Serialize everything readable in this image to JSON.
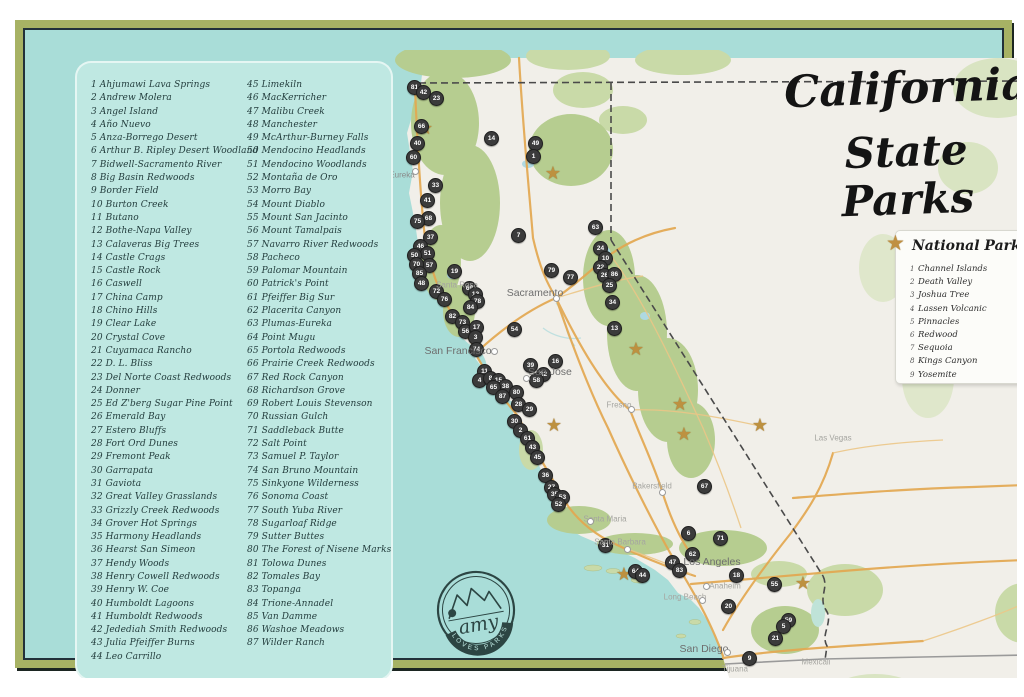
{
  "title": {
    "line1": "California",
    "line2": "State Parks"
  },
  "legend": {
    "title": "National Parks",
    "items": [
      {
        "n": 1,
        "name": "Channel Islands"
      },
      {
        "n": 2,
        "name": "Death Valley"
      },
      {
        "n": 3,
        "name": "Joshua Tree"
      },
      {
        "n": 4,
        "name": "Lassen Volcanic"
      },
      {
        "n": 5,
        "name": "Pinnacles"
      },
      {
        "n": 6,
        "name": "Redwood"
      },
      {
        "n": 7,
        "name": "Sequoia"
      },
      {
        "n": 8,
        "name": "Kings Canyon"
      },
      {
        "n": 9,
        "name": "Yosemite"
      }
    ]
  },
  "logo": {
    "script": "amy",
    "arc": "LOVES PARKS"
  },
  "parks_list": {
    "column1": [
      {
        "n": 1,
        "name": "Ahjumawi Lava Springs"
      },
      {
        "n": 2,
        "name": "Andrew Molera"
      },
      {
        "n": 3,
        "name": "Angel Island"
      },
      {
        "n": 4,
        "name": "Año Nuevo"
      },
      {
        "n": 5,
        "name": "Anza-Borrego Desert"
      },
      {
        "n": 6,
        "name": "Arthur B. Ripley Desert Woodland"
      },
      {
        "n": 7,
        "name": "Bidwell-Sacramento River"
      },
      {
        "n": 8,
        "name": "Big Basin Redwoods"
      },
      {
        "n": 9,
        "name": "Border Field"
      },
      {
        "n": 10,
        "name": "Burton Creek"
      },
      {
        "n": 11,
        "name": "Butano"
      },
      {
        "n": 12,
        "name": "Bothe-Napa Valley"
      },
      {
        "n": 13,
        "name": "Calaveras Big Trees"
      },
      {
        "n": 14,
        "name": "Castle Crags"
      },
      {
        "n": 15,
        "name": "Castle Rock"
      },
      {
        "n": 16,
        "name": "Caswell"
      },
      {
        "n": 17,
        "name": "China Camp"
      },
      {
        "n": 18,
        "name": "Chino Hills"
      },
      {
        "n": 19,
        "name": "Clear Lake"
      },
      {
        "n": 20,
        "name": "Crystal Cove"
      },
      {
        "n": 21,
        "name": "Cuyamaca Rancho"
      },
      {
        "n": 22,
        "name": "D. L. Bliss"
      },
      {
        "n": 23,
        "name": "Del Norte Coast Redwoods"
      },
      {
        "n": 24,
        "name": "Donner"
      },
      {
        "n": 25,
        "name": "Ed Z'berg Sugar Pine Point"
      },
      {
        "n": 26,
        "name": "Emerald Bay"
      },
      {
        "n": 27,
        "name": "Estero Bluffs"
      },
      {
        "n": 28,
        "name": "Fort Ord Dunes"
      },
      {
        "n": 29,
        "name": "Fremont Peak"
      },
      {
        "n": 30,
        "name": "Garrapata"
      },
      {
        "n": 31,
        "name": "Gaviota"
      },
      {
        "n": 32,
        "name": "Great Valley Grasslands"
      },
      {
        "n": 33,
        "name": "Grizzly Creek Redwoods"
      },
      {
        "n": 34,
        "name": "Grover Hot Springs"
      },
      {
        "n": 35,
        "name": "Harmony Headlands"
      },
      {
        "n": 36,
        "name": "Hearst San Simeon"
      },
      {
        "n": 37,
        "name": "Hendy Woods"
      },
      {
        "n": 38,
        "name": "Henry Cowell Redwoods"
      },
      {
        "n": 39,
        "name": "Henry W. Coe"
      },
      {
        "n": 40,
        "name": "Humboldt Lagoons"
      },
      {
        "n": 41,
        "name": "Humboldt Redwoods"
      },
      {
        "n": 42,
        "name": "Jedediah Smith Redwoods"
      },
      {
        "n": 43,
        "name": "Julia Pfeiffer Burns"
      },
      {
        "n": 44,
        "name": "Leo Carrillo"
      }
    ],
    "column2": [
      {
        "n": 45,
        "name": "Limekiln"
      },
      {
        "n": 46,
        "name": "MacKerricher"
      },
      {
        "n": 47,
        "name": "Malibu Creek"
      },
      {
        "n": 48,
        "name": "Manchester"
      },
      {
        "n": 49,
        "name": "McArthur-Burney Falls"
      },
      {
        "n": 50,
        "name": "Mendocino Headlands"
      },
      {
        "n": 51,
        "name": "Mendocino Woodlands"
      },
      {
        "n": 52,
        "name": "Montaña de Oro"
      },
      {
        "n": 53,
        "name": "Morro Bay"
      },
      {
        "n": 54,
        "name": "Mount Diablo"
      },
      {
        "n": 55,
        "name": "Mount San Jacinto"
      },
      {
        "n": 56,
        "name": "Mount Tamalpais"
      },
      {
        "n": 57,
        "name": "Navarro River Redwoods"
      },
      {
        "n": 58,
        "name": "Pacheco"
      },
      {
        "n": 59,
        "name": "Palomar Mountain"
      },
      {
        "n": 60,
        "name": "Patrick's Point"
      },
      {
        "n": 61,
        "name": "Pfeiffer Big Sur"
      },
      {
        "n": 62,
        "name": "Placerita Canyon"
      },
      {
        "n": 63,
        "name": "Plumas-Eureka"
      },
      {
        "n": 64,
        "name": "Point Mugu"
      },
      {
        "n": 65,
        "name": "Portola Redwoods"
      },
      {
        "n": 66,
        "name": "Prairie Creek Redwoods"
      },
      {
        "n": 67,
        "name": "Red Rock Canyon"
      },
      {
        "n": 68,
        "name": "Richardson Grove"
      },
      {
        "n": 69,
        "name": "Robert Louis Stevenson"
      },
      {
        "n": 70,
        "name": "Russian Gulch"
      },
      {
        "n": 71,
        "name": "Saddleback Butte"
      },
      {
        "n": 72,
        "name": "Salt Point"
      },
      {
        "n": 73,
        "name": "Samuel P. Taylor"
      },
      {
        "n": 74,
        "name": "San Bruno Mountain"
      },
      {
        "n": 75,
        "name": "Sinkyone Wilderness"
      },
      {
        "n": 76,
        "name": "Sonoma Coast"
      },
      {
        "n": 77,
        "name": "South Yuba River"
      },
      {
        "n": 78,
        "name": "Sugarloaf Ridge"
      },
      {
        "n": 79,
        "name": "Sutter Buttes"
      },
      {
        "n": 80,
        "name": "The Forest of Nisene Marks"
      },
      {
        "n": 81,
        "name": "Tolowa Dunes"
      },
      {
        "n": 82,
        "name": "Tomales Bay"
      },
      {
        "n": 83,
        "name": "Topanga"
      },
      {
        "n": 84,
        "name": "Trione-Annadel"
      },
      {
        "n": 85,
        "name": "Van Damme"
      },
      {
        "n": 86,
        "name": "Washoe Meadows"
      },
      {
        "n": 87,
        "name": "Wilder Ranch"
      }
    ]
  },
  "map": {
    "cities": [
      {
        "name": "Eureka",
        "x": 379,
        "y": 147,
        "cls": "",
        "dot": {
          "x": 392,
          "y": 143
        }
      },
      {
        "name": "Santa Rosa",
        "x": 434,
        "y": 257,
        "cls": "faint",
        "dot": null
      },
      {
        "name": "Sacramento",
        "x": 512,
        "y": 265,
        "cls": "major",
        "dot": {
          "x": 533,
          "y": 270
        }
      },
      {
        "name": "San Francisco",
        "x": 435,
        "y": 323,
        "cls": "major",
        "dot": {
          "x": 471,
          "y": 323
        }
      },
      {
        "name": "San Jose",
        "x": 527,
        "y": 344,
        "cls": "major",
        "dot": {
          "x": 503,
          "y": 350
        }
      },
      {
        "name": "Fresno",
        "x": 596,
        "y": 377,
        "cls": "faint",
        "dot": {
          "x": 608,
          "y": 381
        }
      },
      {
        "name": "Las Vegas",
        "x": 810,
        "y": 410,
        "cls": "faint",
        "dot": null
      },
      {
        "name": "Bakersfield",
        "x": 629,
        "y": 458,
        "cls": "faint",
        "dot": {
          "x": 639,
          "y": 464
        }
      },
      {
        "name": "Santa Maria",
        "x": 582,
        "y": 491,
        "cls": "faint",
        "dot": {
          "x": 567,
          "y": 493
        }
      },
      {
        "name": "Santa Barbara",
        "x": 597,
        "y": 514,
        "cls": "faint",
        "dot": {
          "x": 604,
          "y": 521
        }
      },
      {
        "name": "Los Angeles",
        "x": 689,
        "y": 534,
        "cls": "major",
        "dot": null
      },
      {
        "name": "Anaheim",
        "x": 702,
        "y": 558,
        "cls": "faint",
        "dot": {
          "x": 683,
          "y": 558
        }
      },
      {
        "name": "Long Beach",
        "x": 662,
        "y": 569,
        "cls": "faint",
        "dot": {
          "x": 679,
          "y": 572
        }
      },
      {
        "name": "San Diego",
        "x": 681,
        "y": 621,
        "cls": "major",
        "dot": {
          "x": 704,
          "y": 624
        }
      },
      {
        "name": "Tijuana",
        "x": 712,
        "y": 641,
        "cls": "faint",
        "dot": null
      },
      {
        "name": "Mexicali",
        "x": 793,
        "y": 634,
        "cls": "faint",
        "dot": null
      }
    ],
    "stars": [
      {
        "name": "Redwood",
        "x": 402,
        "y": 101
      },
      {
        "name": "Lassen Volcanic",
        "x": 530,
        "y": 146
      },
      {
        "name": "Yosemite",
        "x": 613,
        "y": 322
      },
      {
        "name": "Kings Canyon",
        "x": 657,
        "y": 377
      },
      {
        "name": "Sequoia",
        "x": 661,
        "y": 407
      },
      {
        "name": "Death Valley",
        "x": 737,
        "y": 398
      },
      {
        "name": "Pinnacles",
        "x": 531,
        "y": 398
      },
      {
        "name": "Channel Islands",
        "x": 601,
        "y": 547
      },
      {
        "name": "Joshua Tree",
        "x": 780,
        "y": 556
      }
    ],
    "markers": [
      {
        "n": 81,
        "x": 391,
        "y": 59
      },
      {
        "n": 42,
        "x": 400,
        "y": 64
      },
      {
        "n": 23,
        "x": 413,
        "y": 70
      },
      {
        "n": 66,
        "x": 398,
        "y": 98
      },
      {
        "n": 40,
        "x": 394,
        "y": 115
      },
      {
        "n": 60,
        "x": 390,
        "y": 129
      },
      {
        "n": 14,
        "x": 468,
        "y": 110
      },
      {
        "n": 49,
        "x": 512,
        "y": 115
      },
      {
        "n": 1,
        "x": 510,
        "y": 128
      },
      {
        "n": 7,
        "x": 495,
        "y": 207
      },
      {
        "n": 33,
        "x": 412,
        "y": 157
      },
      {
        "n": 41,
        "x": 404,
        "y": 172
      },
      {
        "n": 68,
        "x": 405,
        "y": 190
      },
      {
        "n": 75,
        "x": 394,
        "y": 193
      },
      {
        "n": 37,
        "x": 407,
        "y": 209
      },
      {
        "n": 46,
        "x": 397,
        "y": 218
      },
      {
        "n": 51,
        "x": 404,
        "y": 225
      },
      {
        "n": 50,
        "x": 391,
        "y": 227
      },
      {
        "n": 57,
        "x": 406,
        "y": 237
      },
      {
        "n": 70,
        "x": 393,
        "y": 236
      },
      {
        "n": 85,
        "x": 396,
        "y": 245
      },
      {
        "n": 48,
        "x": 398,
        "y": 255
      },
      {
        "n": 19,
        "x": 431,
        "y": 243
      },
      {
        "n": 69,
        "x": 446,
        "y": 260
      },
      {
        "n": 12,
        "x": 452,
        "y": 266
      },
      {
        "n": 72,
        "x": 413,
        "y": 263
      },
      {
        "n": 76,
        "x": 421,
        "y": 271
      },
      {
        "n": 78,
        "x": 454,
        "y": 273
      },
      {
        "n": 84,
        "x": 447,
        "y": 279
      },
      {
        "n": 82,
        "x": 429,
        "y": 288
      },
      {
        "n": 73,
        "x": 439,
        "y": 294
      },
      {
        "n": 56,
        "x": 442,
        "y": 303
      },
      {
        "n": 17,
        "x": 453,
        "y": 299
      },
      {
        "n": 3,
        "x": 452,
        "y": 309
      },
      {
        "n": 74,
        "x": 453,
        "y": 321
      },
      {
        "n": 63,
        "x": 572,
        "y": 199
      },
      {
        "n": 24,
        "x": 577,
        "y": 220
      },
      {
        "n": 10,
        "x": 582,
        "y": 230
      },
      {
        "n": 22,
        "x": 577,
        "y": 239
      },
      {
        "n": 26,
        "x": 581,
        "y": 247
      },
      {
        "n": 86,
        "x": 591,
        "y": 246
      },
      {
        "n": 25,
        "x": 586,
        "y": 257
      },
      {
        "n": 34,
        "x": 589,
        "y": 274
      },
      {
        "n": 13,
        "x": 591,
        "y": 300
      },
      {
        "n": 77,
        "x": 547,
        "y": 249
      },
      {
        "n": 79,
        "x": 528,
        "y": 242
      },
      {
        "n": 54,
        "x": 491,
        "y": 301
      },
      {
        "n": 39,
        "x": 507,
        "y": 337
      },
      {
        "n": 32,
        "x": 520,
        "y": 346
      },
      {
        "n": 16,
        "x": 532,
        "y": 333
      },
      {
        "n": 58,
        "x": 513,
        "y": 352
      },
      {
        "n": 11,
        "x": 461,
        "y": 343
      },
      {
        "n": 4,
        "x": 456,
        "y": 352
      },
      {
        "n": 8,
        "x": 467,
        "y": 350
      },
      {
        "n": 15,
        "x": 475,
        "y": 352
      },
      {
        "n": 38,
        "x": 482,
        "y": 358
      },
      {
        "n": 65,
        "x": 470,
        "y": 359
      },
      {
        "n": 87,
        "x": 479,
        "y": 368
      },
      {
        "n": 80,
        "x": 493,
        "y": 364
      },
      {
        "n": 28,
        "x": 495,
        "y": 376
      },
      {
        "n": 29,
        "x": 506,
        "y": 381
      },
      {
        "n": 30,
        "x": 491,
        "y": 393
      },
      {
        "n": 2,
        "x": 497,
        "y": 402
      },
      {
        "n": 61,
        "x": 504,
        "y": 410
      },
      {
        "n": 43,
        "x": 509,
        "y": 419
      },
      {
        "n": 45,
        "x": 514,
        "y": 429
      },
      {
        "n": 36,
        "x": 522,
        "y": 447
      },
      {
        "n": 27,
        "x": 528,
        "y": 459
      },
      {
        "n": 35,
        "x": 531,
        "y": 466
      },
      {
        "n": 53,
        "x": 539,
        "y": 469
      },
      {
        "n": 52,
        "x": 535,
        "y": 476
      },
      {
        "n": 31,
        "x": 582,
        "y": 517
      },
      {
        "n": 67,
        "x": 681,
        "y": 458
      },
      {
        "n": 6,
        "x": 665,
        "y": 505
      },
      {
        "n": 71,
        "x": 697,
        "y": 510
      },
      {
        "n": 62,
        "x": 669,
        "y": 526
      },
      {
        "n": 47,
        "x": 649,
        "y": 534
      },
      {
        "n": 83,
        "x": 656,
        "y": 542
      },
      {
        "n": 64,
        "x": 612,
        "y": 543
      },
      {
        "n": 44,
        "x": 619,
        "y": 547
      },
      {
        "n": 18,
        "x": 713,
        "y": 547
      },
      {
        "n": 55,
        "x": 751,
        "y": 556
      },
      {
        "n": 20,
        "x": 705,
        "y": 578
      },
      {
        "n": 59,
        "x": 765,
        "y": 592
      },
      {
        "n": 5,
        "x": 760,
        "y": 598
      },
      {
        "n": 21,
        "x": 752,
        "y": 610
      },
      {
        "n": 9,
        "x": 726,
        "y": 630
      }
    ]
  },
  "colors": {
    "frame_green": "#a7b264",
    "teal_ocean": "#a9ddd8",
    "panel_teal": "#bfe8e2",
    "land": "#f1efe9",
    "forest": "#b6cd90",
    "road_orange": "#e3a851",
    "marker_dark": "#3b3b3b",
    "star_gold": "#bd9140",
    "logo_ink": "#2c4543"
  }
}
